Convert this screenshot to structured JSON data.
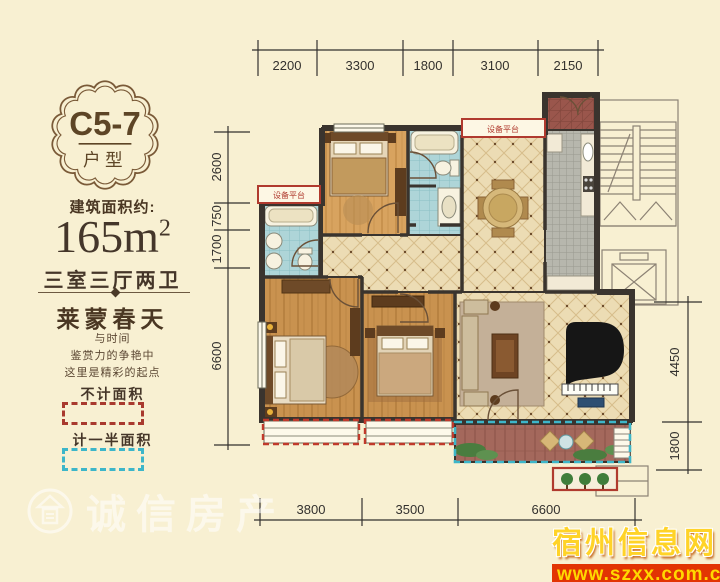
{
  "panel": {
    "badge": {
      "title": "C5-7",
      "subtitle": "户型"
    },
    "area_label": "建筑面积约:",
    "area_value": "165m",
    "area_sup": "2",
    "layout_text": "三室三厅两卫",
    "project_name": "莱蒙春天",
    "slogan1": "与时间",
    "slogan2": "鉴赏力的争艳中",
    "slogan3": "这里是精彩的起点",
    "legend_no_area": "不计面积",
    "legend_half_area": "计一半面积"
  },
  "plan": {
    "label_equipment_left": "设备平台",
    "label_equipment_top": "设备平台"
  },
  "dims": {
    "top": [
      "2200",
      "3300",
      "1800",
      "3100",
      "2150"
    ],
    "left": [
      "2600",
      "750",
      "1700",
      "6600"
    ],
    "right": [
      "4450",
      "1800"
    ],
    "bottom": [
      "3800",
      "3500",
      "6600"
    ]
  },
  "watermarks": {
    "agency": "诚信房产",
    "site_name": "宿州信息网",
    "site_url": "www.szxx.com.cn"
  },
  "colors": {
    "accent_red": "#a93a2e",
    "accent_cyan": "#3db6c9",
    "background": "#f8f0d2",
    "wall": "#3a342e"
  }
}
